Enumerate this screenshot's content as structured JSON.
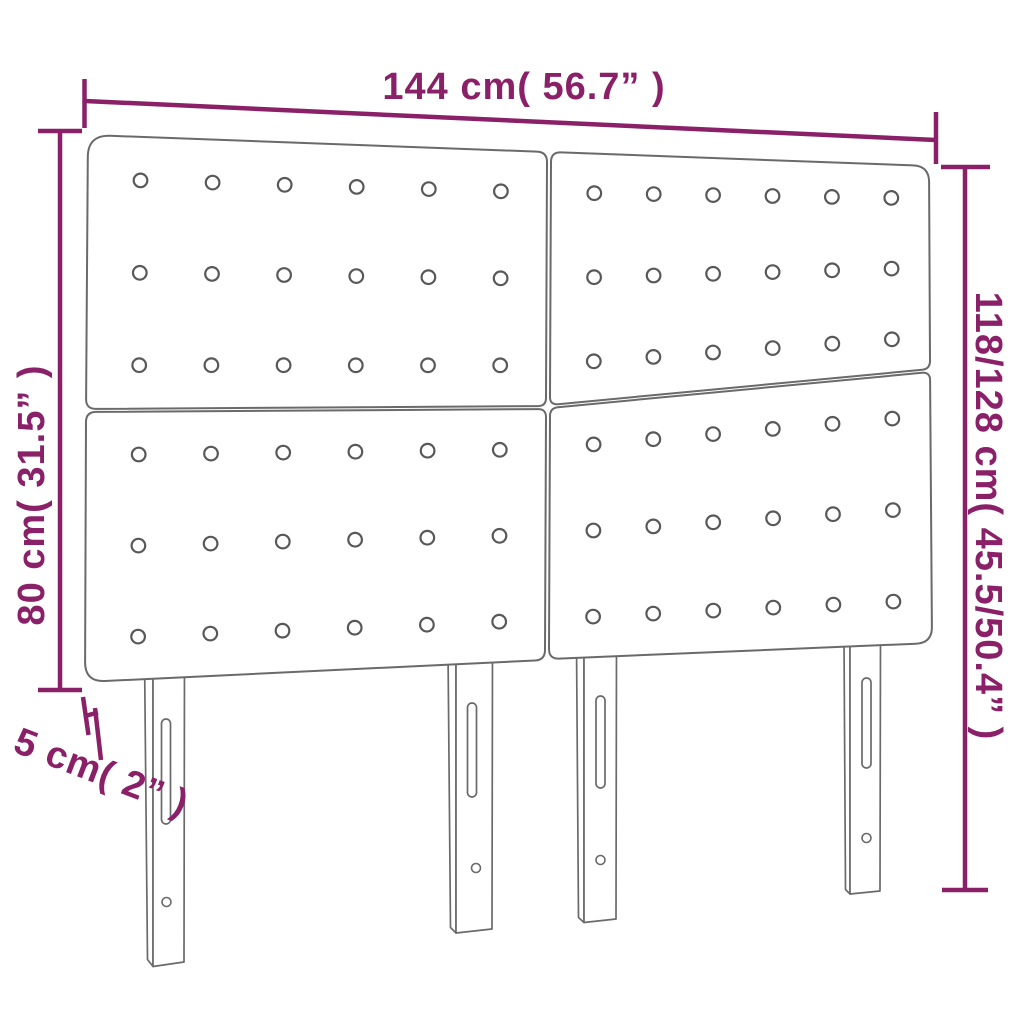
{
  "title": "Headboard dimension diagram",
  "dimensions": {
    "width": "144 cm( 56.7” )",
    "height_panel": "80 cm( 31.5” )",
    "height_total": "118/128 cm( 45.5/50.4” )",
    "thickness": "5 cm( 2” )"
  },
  "figure": {
    "panels": 4,
    "buttons_per_panel": 18,
    "legs": 4
  },
  "colors": {
    "dimension_accent": "#8a2168",
    "outline_gray": "#6a6a6a",
    "background": "#ffffff"
  }
}
